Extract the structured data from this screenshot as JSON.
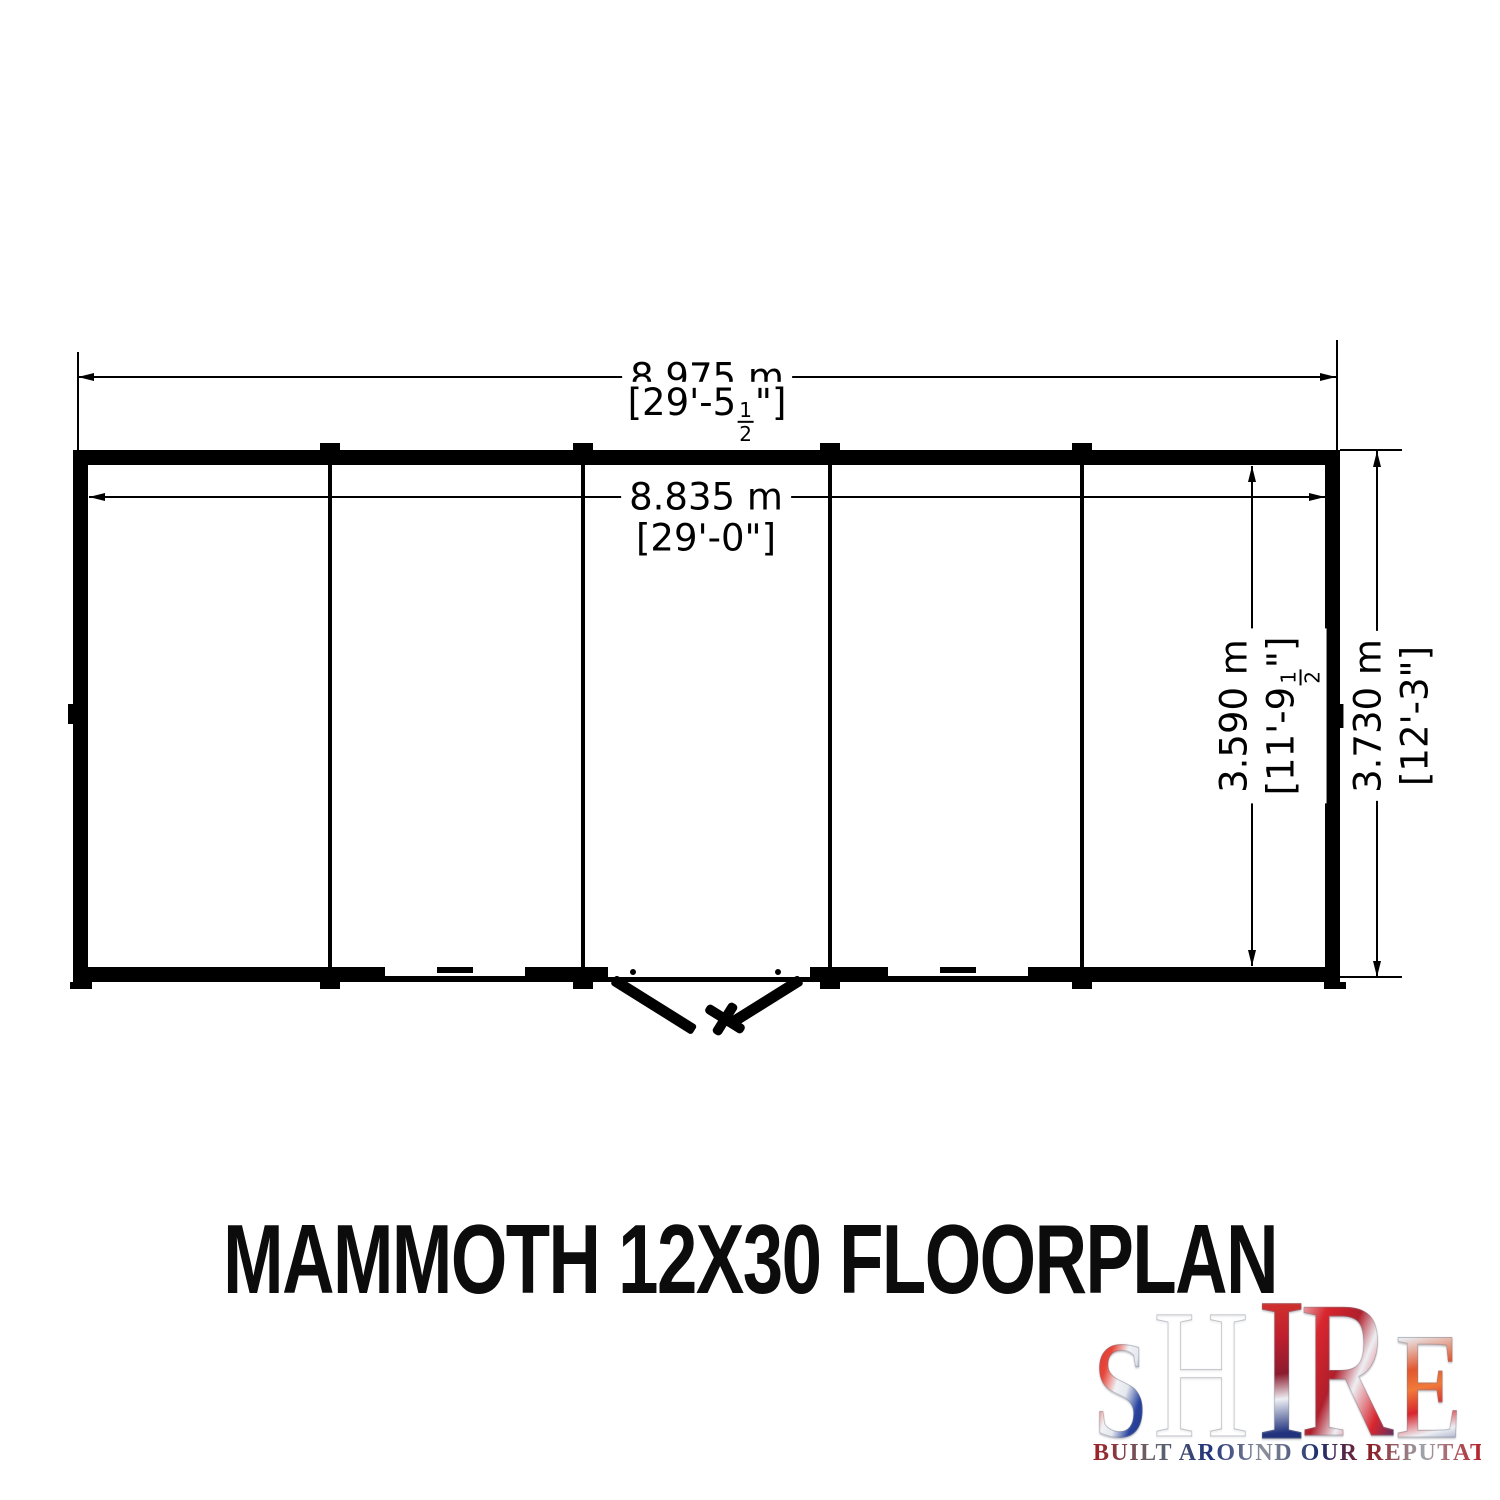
{
  "title": "MAMMOTH 12X30 FLOORPLAN",
  "dims": {
    "outer_width_metric": "8.975 m",
    "outer_width_imp_pre": "[29'-5",
    "outer_width_frac_num": "1",
    "outer_width_frac_den": "2",
    "outer_width_imp_post": "\"]",
    "inner_width_metric": "8.835 m",
    "inner_width_imp": "[29'-0\"]",
    "inner_depth_metric": "3.590 m",
    "inner_depth_imp_pre": "[11'-9",
    "inner_depth_frac_num": "1",
    "inner_depth_frac_den": "2",
    "inner_depth_imp_post": "\"]",
    "outer_depth_metric": "3.730 m",
    "outer_depth_imp": "[12'-3\"]"
  },
  "logo": {
    "letters": [
      "S",
      "H",
      "I",
      "R",
      "E"
    ],
    "tagline": "BUILT AROUND OUR REPUTATION",
    "palette": {
      "red": "#c8202b",
      "navy": "#1c2e6e",
      "silver": "#c9cdd4"
    }
  }
}
